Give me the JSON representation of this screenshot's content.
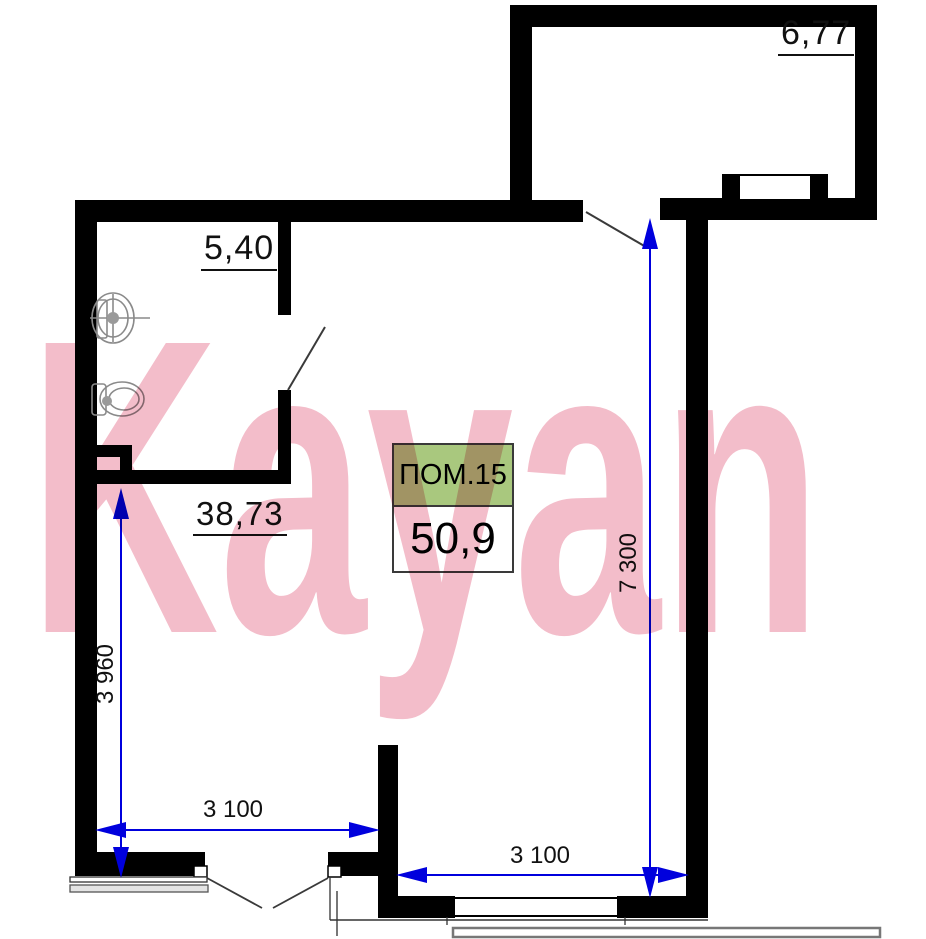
{
  "watermark": {
    "text": "Kayan"
  },
  "unit_label": {
    "title": "ПОМ.15",
    "area": "50,9"
  },
  "rooms": {
    "balcony": {
      "area": "6,77"
    },
    "bathroom": {
      "area": "5,40"
    },
    "living": {
      "area": "38,73"
    }
  },
  "dimensions": {
    "bottom_left_width": "3 100",
    "bottom_right_width": "3 100",
    "left_height": "3 960",
    "right_height": "7 300"
  },
  "colors": {
    "wall": "#000000",
    "dimension-blue": "#0000dd",
    "label-green": "#a9c87e",
    "watermark-pink": "#f3bdca"
  }
}
